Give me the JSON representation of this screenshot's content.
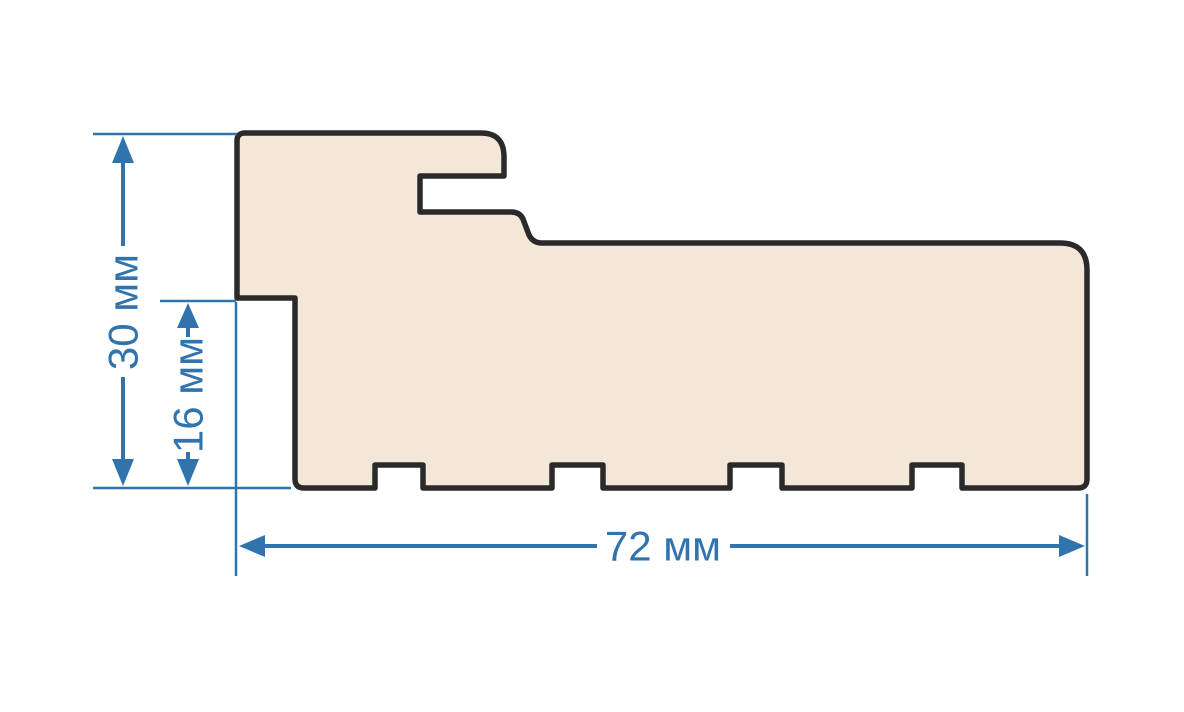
{
  "diagram": {
    "type": "profile-cross-section-drawing",
    "unit": "мм",
    "labels": {
      "height": "30 мм",
      "inner_height": "16 мм",
      "width": "72 мм"
    },
    "values": {
      "height_mm": 30,
      "inner_height_mm": 16,
      "width_mm": 72
    },
    "colors": {
      "background": "#ffffff",
      "profile_fill": "#f3e8d8",
      "profile_outline": "#2a2a2a",
      "dimension_blue": "#3173ad"
    }
  }
}
